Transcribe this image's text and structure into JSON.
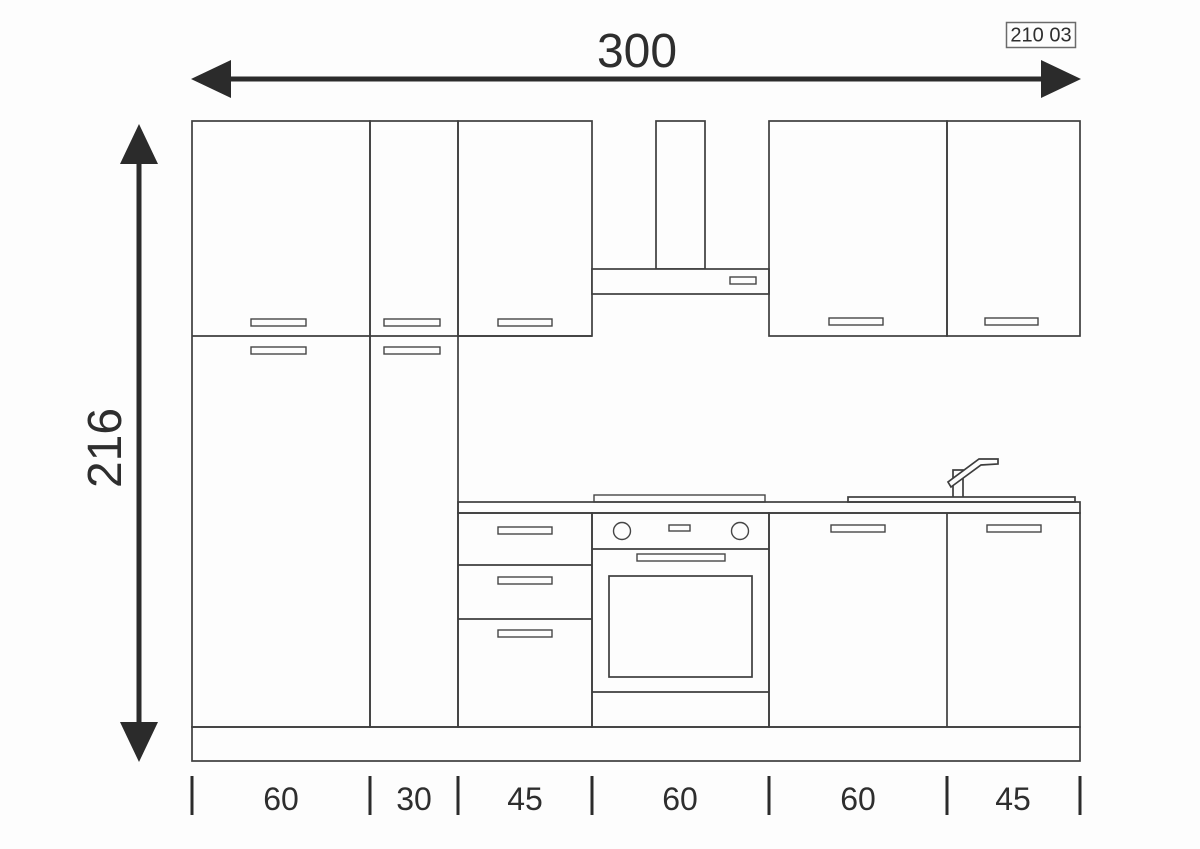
{
  "drawing": {
    "code": "210 03",
    "overall_width_cm": "300",
    "overall_height_cm": "216",
    "segment_widths_cm": [
      "60",
      "30",
      "45",
      "60",
      "60",
      "45"
    ]
  },
  "colors": {
    "background": "#fdfdfd",
    "outline": "#3e3e3e",
    "dimension": "#2b2b2b",
    "text": "#2e2e2e"
  }
}
